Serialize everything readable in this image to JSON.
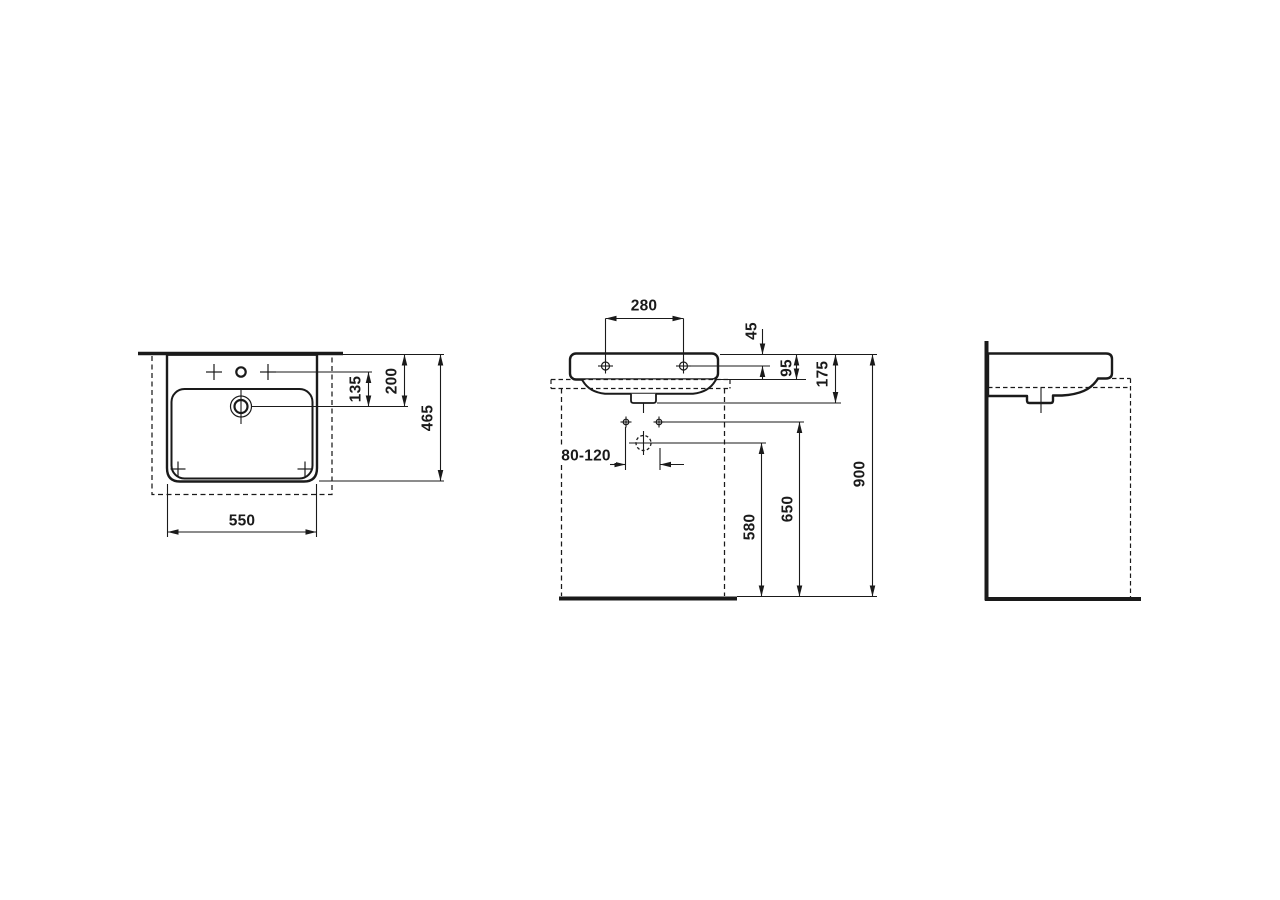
{
  "drawing": {
    "background_color": "#ffffff",
    "line_color": "#1a1a1a",
    "dimensions": {
      "plan": {
        "tap_to_drain": "135",
        "rear_to_drain": "200",
        "depth": "465",
        "width": "550"
      },
      "front": {
        "tap_hole_spacing": "280",
        "rim_to_tap_hole": "45",
        "rim_to_apron_bottom": "95",
        "basin_height": "175",
        "fixing_span": "80-120",
        "floor_to_drain": "580",
        "floor_to_fixing": "650",
        "floor_to_rim": "900"
      }
    }
  }
}
